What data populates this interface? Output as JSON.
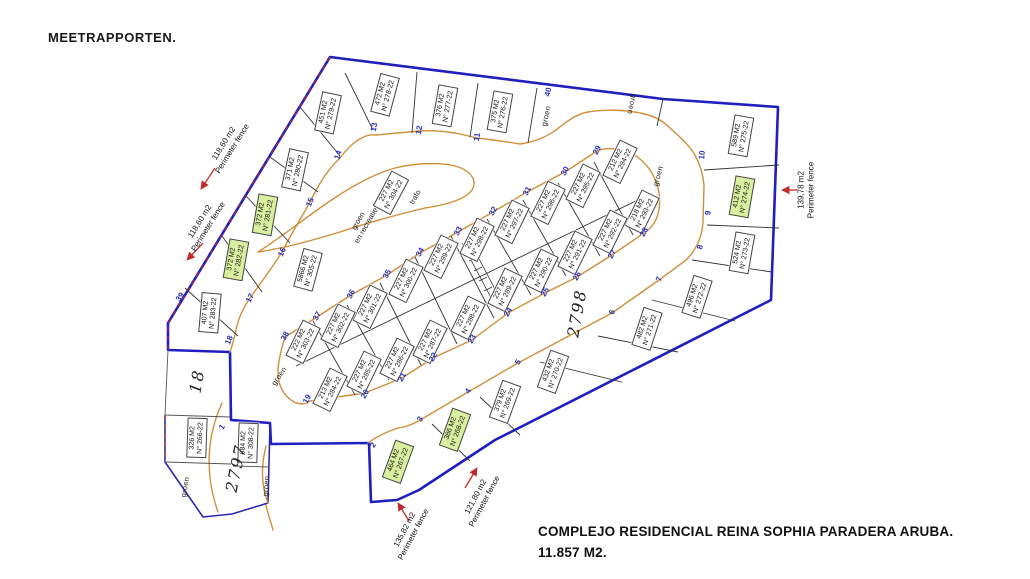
{
  "page_title": "MEETRAPPORTEN.",
  "title_block": {
    "line1": "COMPLEJO RESIDENCIAL REINA SOPHIA PARADERA ARUBA.",
    "line2": "11.857 M2."
  },
  "map": {
    "colors": {
      "boundary": "#1f1fbf",
      "road": "#cf8f3a",
      "parcel_line": "#333333",
      "street_number": "#2431b8",
      "highlight": "#d9efa0",
      "fence_arrow": "#c22b2b"
    },
    "lots": [
      {
        "area": "451 M2",
        "num": "N° 279-22",
        "x": 328,
        "y": 113,
        "rot": -78,
        "hl": false
      },
      {
        "area": "472 M2",
        "num": "N° 278-22",
        "x": 385,
        "y": 95,
        "rot": -75,
        "hl": false
      },
      {
        "area": "376 M2",
        "num": "N° 277-22",
        "x": 445,
        "y": 106,
        "rot": -80,
        "hl": false
      },
      {
        "area": "375 M2",
        "num": "N° 276-22",
        "x": 500,
        "y": 112,
        "rot": -80,
        "hl": false
      },
      {
        "area": "589 M2",
        "num": "N° 275-22",
        "x": 741,
        "y": 136,
        "rot": -80,
        "hl": false
      },
      {
        "area": "412 M2",
        "num": "N° 274-22",
        "x": 742,
        "y": 197,
        "rot": -80,
        "hl": true
      },
      {
        "area": "524 M2",
        "num": "N° 273-22",
        "x": 742,
        "y": 253,
        "rot": -80,
        "hl": false
      },
      {
        "area": "496 M2",
        "num": "N° 272-22",
        "x": 697,
        "y": 297,
        "rot": -72,
        "hl": false
      },
      {
        "area": "482 M2",
        "num": "N° 271-22",
        "x": 647,
        "y": 329,
        "rot": -72,
        "hl": false
      },
      {
        "area": "432 M2",
        "num": "N° 270-22",
        "x": 553,
        "y": 372,
        "rot": -70,
        "hl": false
      },
      {
        "area": "379 M2",
        "num": "N° 269-22",
        "x": 505,
        "y": 402,
        "rot": -70,
        "hl": false
      },
      {
        "area": "386 M2",
        "num": "N° 268-22",
        "x": 455,
        "y": 430,
        "rot": -70,
        "hl": true
      },
      {
        "area": "464 M2",
        "num": "N° 267-22",
        "x": 398,
        "y": 462,
        "rot": -70,
        "hl": true
      },
      {
        "area": "326 M2",
        "num": "N° 266-22",
        "x": 197,
        "y": 438,
        "rot": -88,
        "hl": false
      },
      {
        "area": "684 M2",
        "num": "N° 308-22",
        "x": 248,
        "y": 443,
        "rot": -88,
        "hl": false
      },
      {
        "area": "407 M2",
        "num": "N° 283-22",
        "x": 210,
        "y": 313,
        "rot": -85,
        "hl": false
      },
      {
        "area": "372 M2",
        "num": "N° 282-22",
        "x": 236,
        "y": 260,
        "rot": -80,
        "hl": true
      },
      {
        "area": "372 M2",
        "num": "N° 281-22",
        "x": 265,
        "y": 215,
        "rot": -80,
        "hl": true
      },
      {
        "area": "371 M2",
        "num": "N° 280-22",
        "x": 295,
        "y": 170,
        "rot": -78,
        "hl": false
      },
      {
        "area": "5866 M2",
        "num": "N° 305-22",
        "x": 308,
        "y": 270,
        "rot": -75,
        "hl": false
      },
      {
        "area": "227 M2",
        "num": "N° 304-22",
        "x": 391,
        "y": 193,
        "rot": -62,
        "hl": false
      },
      {
        "area": "212 M2",
        "num": "N° 294-22",
        "x": 620,
        "y": 162,
        "rot": -64,
        "hl": false
      },
      {
        "area": "227 M2",
        "num": "N° 295-22",
        "x": 583,
        "y": 186,
        "rot": -64,
        "hl": false
      },
      {
        "area": "227 M2",
        "num": "N° 296-22",
        "x": 548,
        "y": 203,
        "rot": -64,
        "hl": false
      },
      {
        "area": "227 M2",
        "num": "N° 297-22",
        "x": 512,
        "y": 222,
        "rot": -64,
        "hl": false
      },
      {
        "area": "227 M2",
        "num": "N° 298-22",
        "x": 477,
        "y": 240,
        "rot": -64,
        "hl": false
      },
      {
        "area": "227 M2",
        "num": "N° 299-22",
        "x": 441,
        "y": 257,
        "rot": -64,
        "hl": false
      },
      {
        "area": "227 M2",
        "num": "N° 300-22",
        "x": 406,
        "y": 281,
        "rot": -64,
        "hl": false
      },
      {
        "area": "227 M2",
        "num": "N° 301-22",
        "x": 370,
        "y": 307,
        "rot": -64,
        "hl": false
      },
      {
        "area": "227 M2",
        "num": "N° 302-22",
        "x": 338,
        "y": 326,
        "rot": -64,
        "hl": false
      },
      {
        "area": "222 M2",
        "num": "N° 303-22",
        "x": 303,
        "y": 342,
        "rot": -64,
        "hl": false
      },
      {
        "area": "218 M2",
        "num": "N° 293-22",
        "x": 642,
        "y": 212,
        "rot": -64,
        "hl": false
      },
      {
        "area": "227 M2",
        "num": "N° 292-22",
        "x": 610,
        "y": 232,
        "rot": -64,
        "hl": false
      },
      {
        "area": "227 M2",
        "num": "N° 291-22",
        "x": 575,
        "y": 253,
        "rot": -64,
        "hl": false
      },
      {
        "area": "227 M2",
        "num": "N° 290-22",
        "x": 541,
        "y": 271,
        "rot": -64,
        "hl": false
      },
      {
        "area": "227 M2",
        "num": "N° 289-22",
        "x": 505,
        "y": 290,
        "rot": -64,
        "hl": false
      },
      {
        "area": "227 M2",
        "num": "N° 288-22",
        "x": 468,
        "y": 318,
        "rot": -64,
        "hl": false
      },
      {
        "area": "227 M2",
        "num": "N° 287-22",
        "x": 430,
        "y": 342,
        "rot": -64,
        "hl": false
      },
      {
        "area": "227 M2",
        "num": "N° 286-22",
        "x": 397,
        "y": 360,
        "rot": -64,
        "hl": false
      },
      {
        "area": "227 M2",
        "num": "N° 285-22",
        "x": 364,
        "y": 373,
        "rot": -64,
        "hl": false
      },
      {
        "area": "213 M2",
        "num": "N° 284-22",
        "x": 330,
        "y": 390,
        "rot": -64,
        "hl": false
      }
    ],
    "street_numbers": [
      {
        "n": "1",
        "x": 222,
        "y": 427,
        "rot": -55
      },
      {
        "n": "2",
        "x": 373,
        "y": 445,
        "rot": -58
      },
      {
        "n": "3",
        "x": 420,
        "y": 419,
        "rot": -58
      },
      {
        "n": "4",
        "x": 468,
        "y": 391,
        "rot": -58
      },
      {
        "n": "5",
        "x": 518,
        "y": 362,
        "rot": -58
      },
      {
        "n": "6",
        "x": 612,
        "y": 312,
        "rot": -70
      },
      {
        "n": "7",
        "x": 659,
        "y": 279,
        "rot": -72
      },
      {
        "n": "8",
        "x": 700,
        "y": 247,
        "rot": -78
      },
      {
        "n": "9",
        "x": 708,
        "y": 213,
        "rot": -85
      },
      {
        "n": "10",
        "x": 702,
        "y": 155,
        "rot": -85
      },
      {
        "n": "11",
        "x": 477,
        "y": 137,
        "rot": -80
      },
      {
        "n": "12",
        "x": 419,
        "y": 130,
        "rot": -80
      },
      {
        "n": "13",
        "x": 374,
        "y": 127,
        "rot": -80
      },
      {
        "n": "14",
        "x": 338,
        "y": 155,
        "rot": -72
      },
      {
        "n": "15",
        "x": 310,
        "y": 202,
        "rot": -68
      },
      {
        "n": "16",
        "x": 282,
        "y": 252,
        "rot": -65
      },
      {
        "n": "17",
        "x": 250,
        "y": 298,
        "rot": -62
      },
      {
        "n": "18",
        "x": 229,
        "y": 340,
        "rot": -68
      },
      {
        "n": "19",
        "x": 307,
        "y": 399,
        "rot": -60
      },
      {
        "n": "20",
        "x": 365,
        "y": 394,
        "rot": -60
      },
      {
        "n": "21",
        "x": 402,
        "y": 377,
        "rot": -60
      },
      {
        "n": "22",
        "x": 433,
        "y": 357,
        "rot": -60
      },
      {
        "n": "23",
        "x": 472,
        "y": 339,
        "rot": -60
      },
      {
        "n": "24",
        "x": 508,
        "y": 312,
        "rot": -60
      },
      {
        "n": "25",
        "x": 545,
        "y": 292,
        "rot": -60
      },
      {
        "n": "26",
        "x": 577,
        "y": 276,
        "rot": -60
      },
      {
        "n": "27",
        "x": 612,
        "y": 254,
        "rot": -60
      },
      {
        "n": "28",
        "x": 644,
        "y": 232,
        "rot": -60
      },
      {
        "n": "29",
        "x": 597,
        "y": 150,
        "rot": -60
      },
      {
        "n": "30",
        "x": 565,
        "y": 171,
        "rot": -60
      },
      {
        "n": "31",
        "x": 527,
        "y": 191,
        "rot": -60
      },
      {
        "n": "32",
        "x": 493,
        "y": 211,
        "rot": -60
      },
      {
        "n": "33",
        "x": 458,
        "y": 231,
        "rot": -60
      },
      {
        "n": "34",
        "x": 420,
        "y": 252,
        "rot": -60
      },
      {
        "n": "35",
        "x": 387,
        "y": 274,
        "rot": -60
      },
      {
        "n": "36",
        "x": 351,
        "y": 294,
        "rot": -60
      },
      {
        "n": "37",
        "x": 317,
        "y": 316,
        "rot": -60
      },
      {
        "n": "38",
        "x": 285,
        "y": 336,
        "rot": -60
      },
      {
        "n": "39",
        "x": 180,
        "y": 297,
        "rot": -55
      },
      {
        "n": "40",
        "x": 548,
        "y": 92,
        "rot": -78
      }
    ],
    "green_labels": [
      {
        "text": "groen",
        "x": 546,
        "y": 116,
        "rot": -78
      },
      {
        "text": "groen",
        "x": 632,
        "y": 104,
        "rot": 102
      },
      {
        "text": "groen",
        "x": 658,
        "y": 176,
        "rot": -75
      },
      {
        "text": "groen",
        "x": 279,
        "y": 376,
        "rot": -55
      },
      {
        "text": "groen",
        "x": 185,
        "y": 487,
        "rot": -80
      },
      {
        "text": "groen",
        "x": 266,
        "y": 486,
        "rot": -85
      }
    ],
    "special_labels": [
      {
        "line1": "groen",
        "line2": "en recreatie",
        "x": 362,
        "y": 223,
        "rot": -60
      },
      {
        "line1": "trafo",
        "line2": "",
        "x": 415,
        "y": 197,
        "rot": -60
      }
    ],
    "parcel_ids": [
      {
        "text": "2797",
        "x": 236,
        "y": 468,
        "rot": -78
      },
      {
        "text": "2798",
        "x": 577,
        "y": 313,
        "rot": -80
      },
      {
        "text": "18",
        "x": 197,
        "y": 381,
        "rot": -80
      }
    ],
    "fence_labels": [
      {
        "line1": "118,60 m2",
        "line2": "Perimeter fence",
        "x": 228,
        "y": 146,
        "rot": -58
      },
      {
        "line1": "118,60 m2",
        "line2": "Perimeter fence",
        "x": 204,
        "y": 224,
        "rot": -58
      },
      {
        "line1": "139,78 m2",
        "line2": "Perimeter fence",
        "x": 806,
        "y": 190,
        "rot": -90
      },
      {
        "line1": "135,82 m2",
        "line2": "Perimeter fence",
        "x": 409,
        "y": 532,
        "rot": -62
      },
      {
        "line1": "121,80 m2",
        "line2": "Perimeter fence",
        "x": 480,
        "y": 499,
        "rot": -62
      }
    ]
  }
}
